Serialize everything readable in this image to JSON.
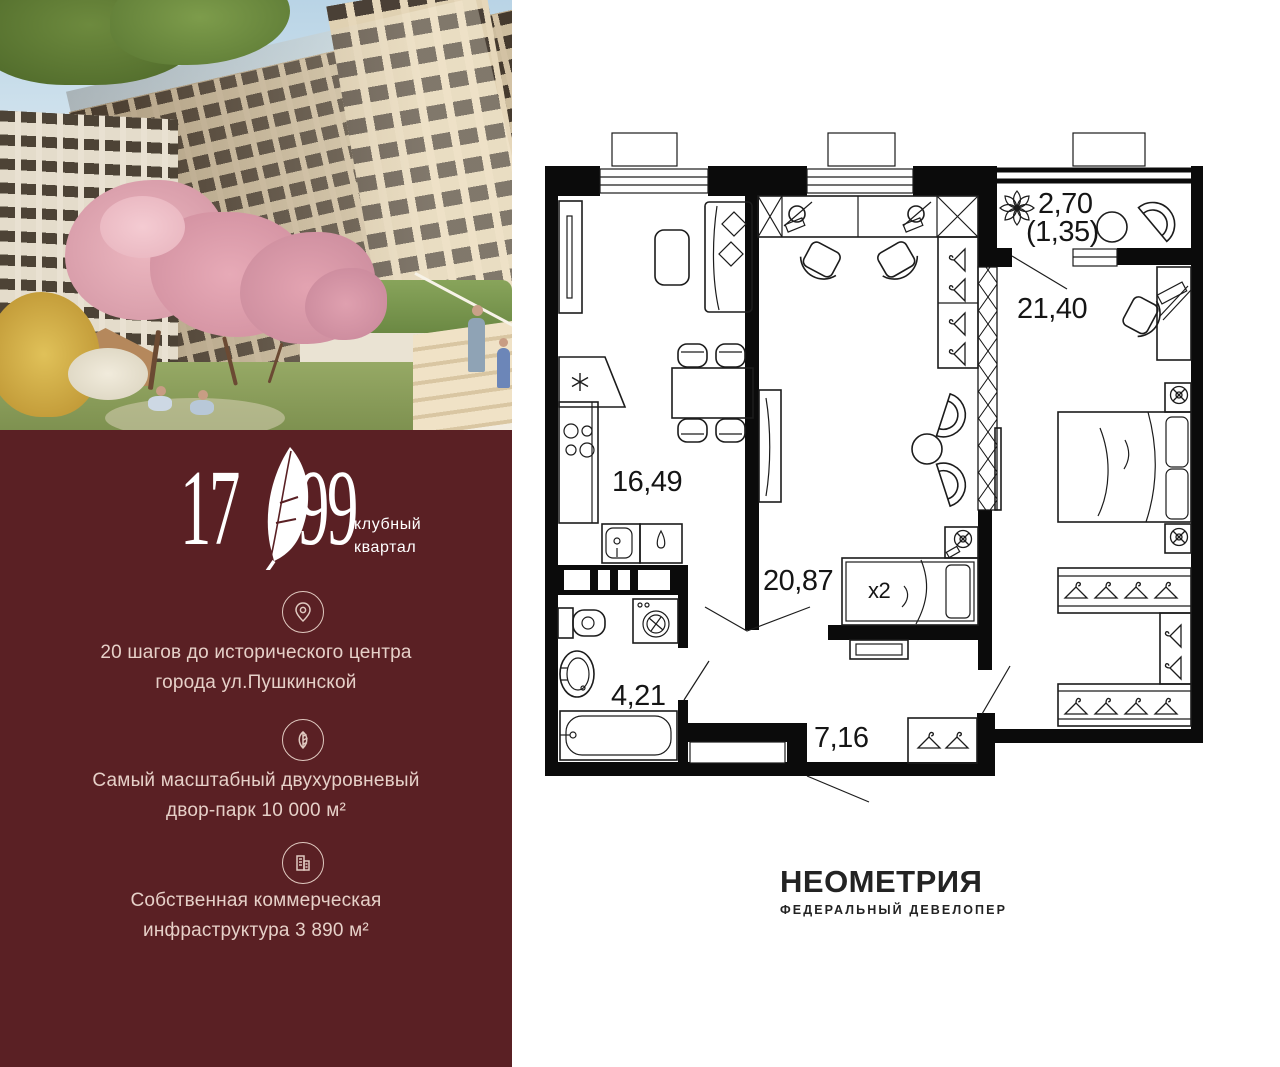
{
  "brand": {
    "panel_bg": "#5a2024",
    "text_color": "#e6d0c8",
    "logo_left": "17",
    "logo_right": "99",
    "logo_sub_line1": "клубный",
    "logo_sub_line2": "квартал",
    "features": [
      {
        "icon": "location-pin",
        "line1": "20 шагов до исторического центра",
        "line2": "города ул.Пушкинской"
      },
      {
        "icon": "leaf",
        "line1": "Самый масштабный двухуровневый",
        "line2": "двор-парк 10 000 м²"
      },
      {
        "icon": "building",
        "line1": "Собственная коммерческая",
        "line2": "инфраструктура 3 890 м²"
      }
    ]
  },
  "floorplan": {
    "ink_color": "#1c1c1c",
    "labels": {
      "balcony_area": "2,70",
      "balcony_reduced": "(1,35)",
      "bedroom_area": "21,40",
      "kitchen_area": "16,49",
      "living_area": "20,87",
      "bed_multiplier": "x2",
      "bathroom_area": "4,21",
      "hallway_area": "7,16"
    }
  },
  "developer": {
    "name": "НЕОМЕТРИЯ",
    "tagline": "ФЕДЕРАЛЬНЫЙ ДЕВЕЛОПЕР"
  }
}
